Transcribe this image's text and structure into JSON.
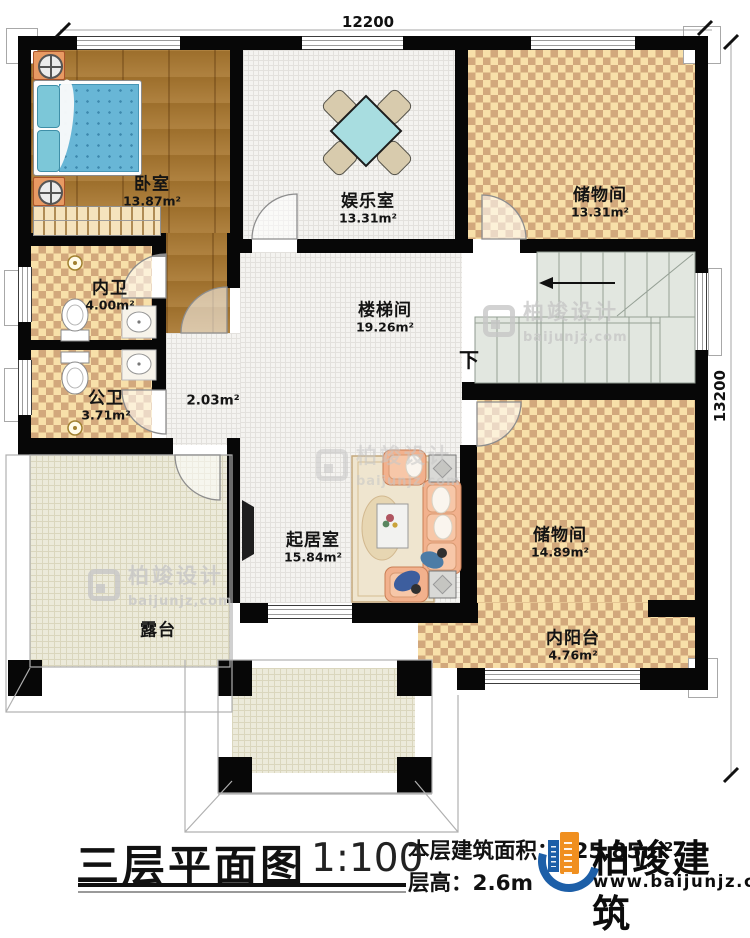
{
  "dimensions": {
    "top": "12200",
    "right": "13200"
  },
  "rooms": {
    "bedroom": {
      "name": "卧室",
      "area": "13.87m²"
    },
    "entertainment": {
      "name": "娱乐室",
      "area": "13.31m²"
    },
    "storage_top": {
      "name": "储物间",
      "area": "13.31m²"
    },
    "inner_bath": {
      "name": "内卫",
      "area": "4.00m²"
    },
    "public_bath": {
      "name": "公卫",
      "area": "3.71m²"
    },
    "stair_hall": {
      "name": "楼梯间",
      "area": "19.26m²"
    },
    "hall": {
      "area": "2.03m²"
    },
    "living": {
      "name": "起居室",
      "area": "15.84m²"
    },
    "storage_bottom": {
      "name": "储物间",
      "area": "14.89m²"
    },
    "inner_balcony": {
      "name": "内阳台",
      "area": "4.76m²"
    },
    "terrace": {
      "name": "露台"
    }
  },
  "stairs": {
    "down_label": "下"
  },
  "watermark": {
    "brand": "柏竣设计",
    "url": "baijunjz,com"
  },
  "footer": {
    "title": "三层平面图",
    "scale": "1:100",
    "area_label": "本层建筑面积：",
    "area_value": "125.85m²",
    "height_label": "层高：",
    "height_value": "2.6m",
    "brand": "柏竣建筑",
    "brand_url": "www.baijunjz.com"
  },
  "colors": {
    "wall": "#070707",
    "checker_dark": "#d2a87c",
    "checker_light": "#f8e0a9",
    "wood": "#a87730",
    "stair": "#e2e7e0",
    "brand_blue": "#1d5fa8",
    "brand_orange": "#f08f1f"
  }
}
